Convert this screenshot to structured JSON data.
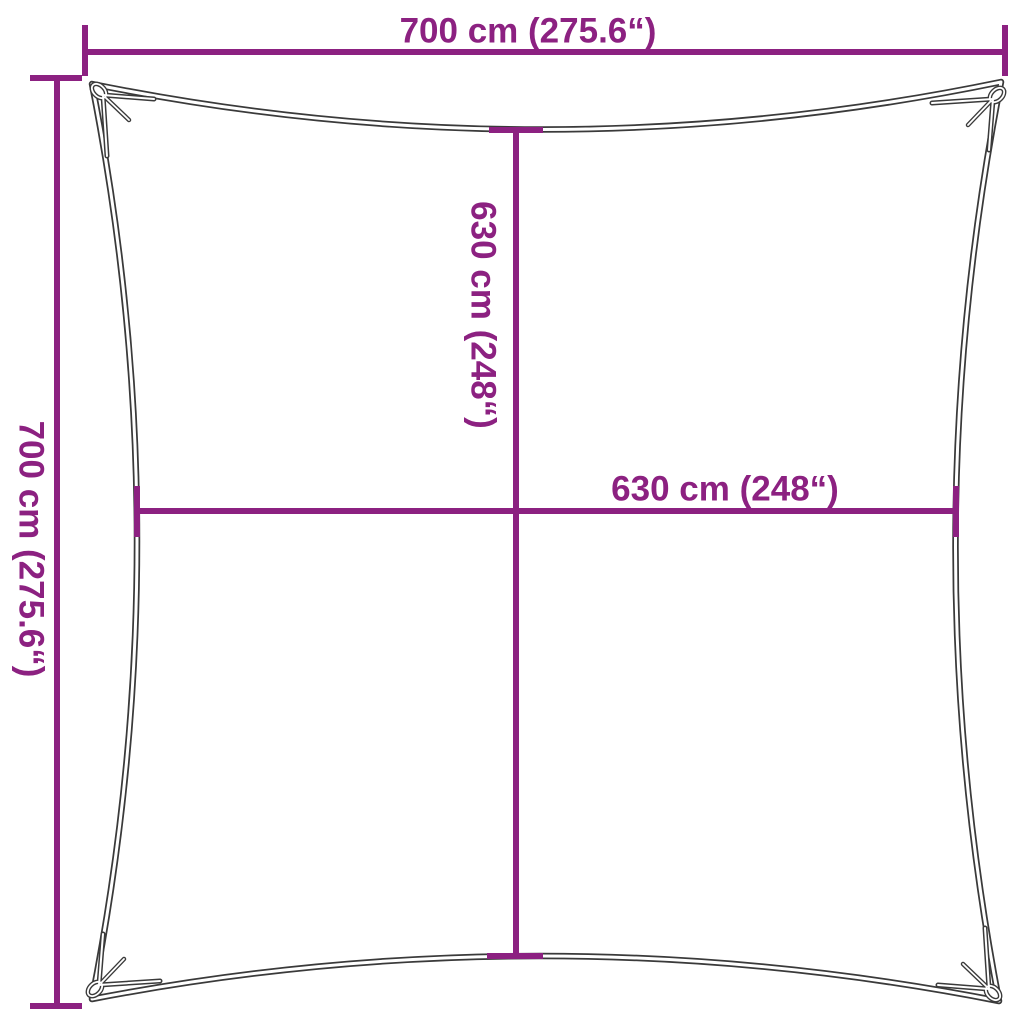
{
  "diagram": {
    "type": "product-dimension-diagram",
    "subject": "square shade sail with corner eyelets, edges curved inward",
    "background": "#ffffff",
    "colors": {
      "dimension_lines_and_text": "#8c2181",
      "sail_outline": "#3a3a3a"
    },
    "dimensions": {
      "top_width": {
        "label": "700 cm (275.6“)",
        "cm": 700,
        "inches": 275.6
      },
      "left_height": {
        "label": "700 cm (275.6“)",
        "cm": 700,
        "inches": 275.6
      },
      "center_height": {
        "label": "630 cm (248“)",
        "cm": 630,
        "inches": 248
      },
      "center_width": {
        "label": "630 cm (248“)",
        "cm": 630,
        "inches": 248
      }
    }
  }
}
